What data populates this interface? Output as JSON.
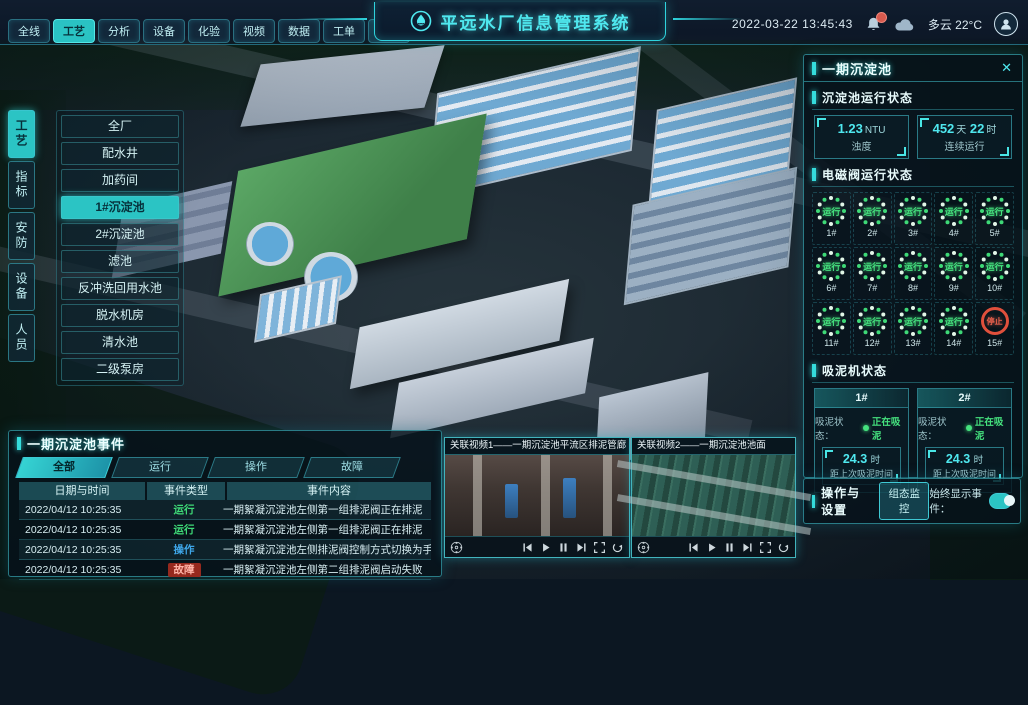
{
  "colors": {
    "accent": "#35dcdc",
    "running_green": "#3ed977",
    "stopped_red": "#e0503c",
    "operation_blue": "#3ea6e8",
    "fault_badge": "#96291e",
    "active_tab_bg": "#2bc4c4"
  },
  "header": {
    "title": "平远水厂信息管理系统",
    "logo_icon": "water-drop-logo",
    "tabs": [
      {
        "label": "全线",
        "active": false
      },
      {
        "label": "工艺",
        "active": true
      },
      {
        "label": "分析",
        "active": false
      },
      {
        "label": "设备",
        "active": false
      },
      {
        "label": "化验",
        "active": false
      },
      {
        "label": "视频",
        "active": false
      },
      {
        "label": "数据",
        "active": false
      },
      {
        "label": "工单",
        "active": false
      },
      {
        "label": "系统",
        "active": false
      }
    ],
    "datetime": "2022-03-22 13:45:43",
    "notification_icon": "bell-icon",
    "weather": {
      "icon": "cloud-icon",
      "text": "多云 22°C"
    }
  },
  "side_tabs": [
    {
      "label": "工艺",
      "active": true
    },
    {
      "label": "指标",
      "active": false
    },
    {
      "label": "安防",
      "active": false
    },
    {
      "label": "设备",
      "active": false
    },
    {
      "label": "人员",
      "active": false
    }
  ],
  "area_menu": {
    "items": [
      "全厂",
      "配水井",
      "加药间",
      "1#沉淀池",
      "2#沉淀池",
      "滤池",
      "反冲洗回用水池",
      "脱水机房",
      "清水池",
      "二级泵房"
    ],
    "active_index": 3
  },
  "right_panel": {
    "title": "一期沉淀池",
    "close_icon": "close-icon",
    "run_status": {
      "title": "沉淀池运行状态",
      "stat1": {
        "value": "1.23",
        "unit": "NTU",
        "label": "浊度"
      },
      "stat2": {
        "value1": "452",
        "unit1": "天",
        "value2": "22",
        "unit2": "时",
        "label": "连续运行"
      }
    },
    "valves": {
      "title": "电磁阀运行状态",
      "items": [
        {
          "id": "1#",
          "status": "运行",
          "state": "run"
        },
        {
          "id": "2#",
          "status": "运行",
          "state": "run"
        },
        {
          "id": "3#",
          "status": "运行",
          "state": "run"
        },
        {
          "id": "4#",
          "status": "运行",
          "state": "run"
        },
        {
          "id": "5#",
          "status": "运行",
          "state": "run"
        },
        {
          "id": "6#",
          "status": "运行",
          "state": "run"
        },
        {
          "id": "7#",
          "status": "运行",
          "state": "run"
        },
        {
          "id": "8#",
          "status": "运行",
          "state": "run"
        },
        {
          "id": "9#",
          "status": "运行",
          "state": "run"
        },
        {
          "id": "10#",
          "status": "运行",
          "state": "run"
        },
        {
          "id": "11#",
          "status": "运行",
          "state": "run"
        },
        {
          "id": "12#",
          "status": "运行",
          "state": "run"
        },
        {
          "id": "13#",
          "status": "运行",
          "state": "run"
        },
        {
          "id": "14#",
          "status": "运行",
          "state": "run"
        },
        {
          "id": "15#",
          "status": "停止",
          "state": "stop"
        }
      ]
    },
    "mud": {
      "title": "吸泥机状态",
      "machines": [
        {
          "id": "1#",
          "status_label": "吸泥状态：",
          "status": "正在吸泥",
          "value": "24.3",
          "unit": "时",
          "label": "距上次吸泥时间"
        },
        {
          "id": "2#",
          "status_label": "吸泥状态：",
          "status": "正在吸泥",
          "value": "24.3",
          "unit": "时",
          "label": "距上次吸泥时间"
        }
      ]
    }
  },
  "settings": {
    "title": "操作与设置",
    "button_label": "组态监控",
    "toggle_label": "始终显示事件：",
    "toggle_on": true
  },
  "events": {
    "title": "一期沉淀池事件",
    "tabs": [
      "全部",
      "运行",
      "操作",
      "故障"
    ],
    "active_tab": 0,
    "columns": [
      "日期与时间",
      "事件类型",
      "事件内容"
    ],
    "rows": [
      {
        "time": "2022/04/12 10:25:35",
        "type": "运行",
        "type_class": "run",
        "content": "一期絮凝沉淀池左侧第一组排泥阀正在排泥"
      },
      {
        "time": "2022/04/12 10:25:35",
        "type": "运行",
        "type_class": "run",
        "content": "一期絮凝沉淀池左侧第一组排泥阀正在排泥"
      },
      {
        "time": "2022/04/12 10:25:35",
        "type": "操作",
        "type_class": "op",
        "content": "一期絮凝沉淀池左侧排泥阀控制方式切换为手动"
      },
      {
        "time": "2022/04/12 10:25:35",
        "type": "故障",
        "type_class": "fault",
        "content": "一期絮凝沉淀池左侧第二组排泥阀启动失败"
      }
    ]
  },
  "videos": [
    {
      "title": "关联视频1——一期沉淀池平流区排泥管廊"
    },
    {
      "title": "关联视频2——一期沉淀池池面"
    }
  ],
  "video_controls": [
    "ptz-pad",
    "skip-back",
    "play",
    "pause",
    "skip-forward",
    "fullscreen",
    "loop"
  ]
}
